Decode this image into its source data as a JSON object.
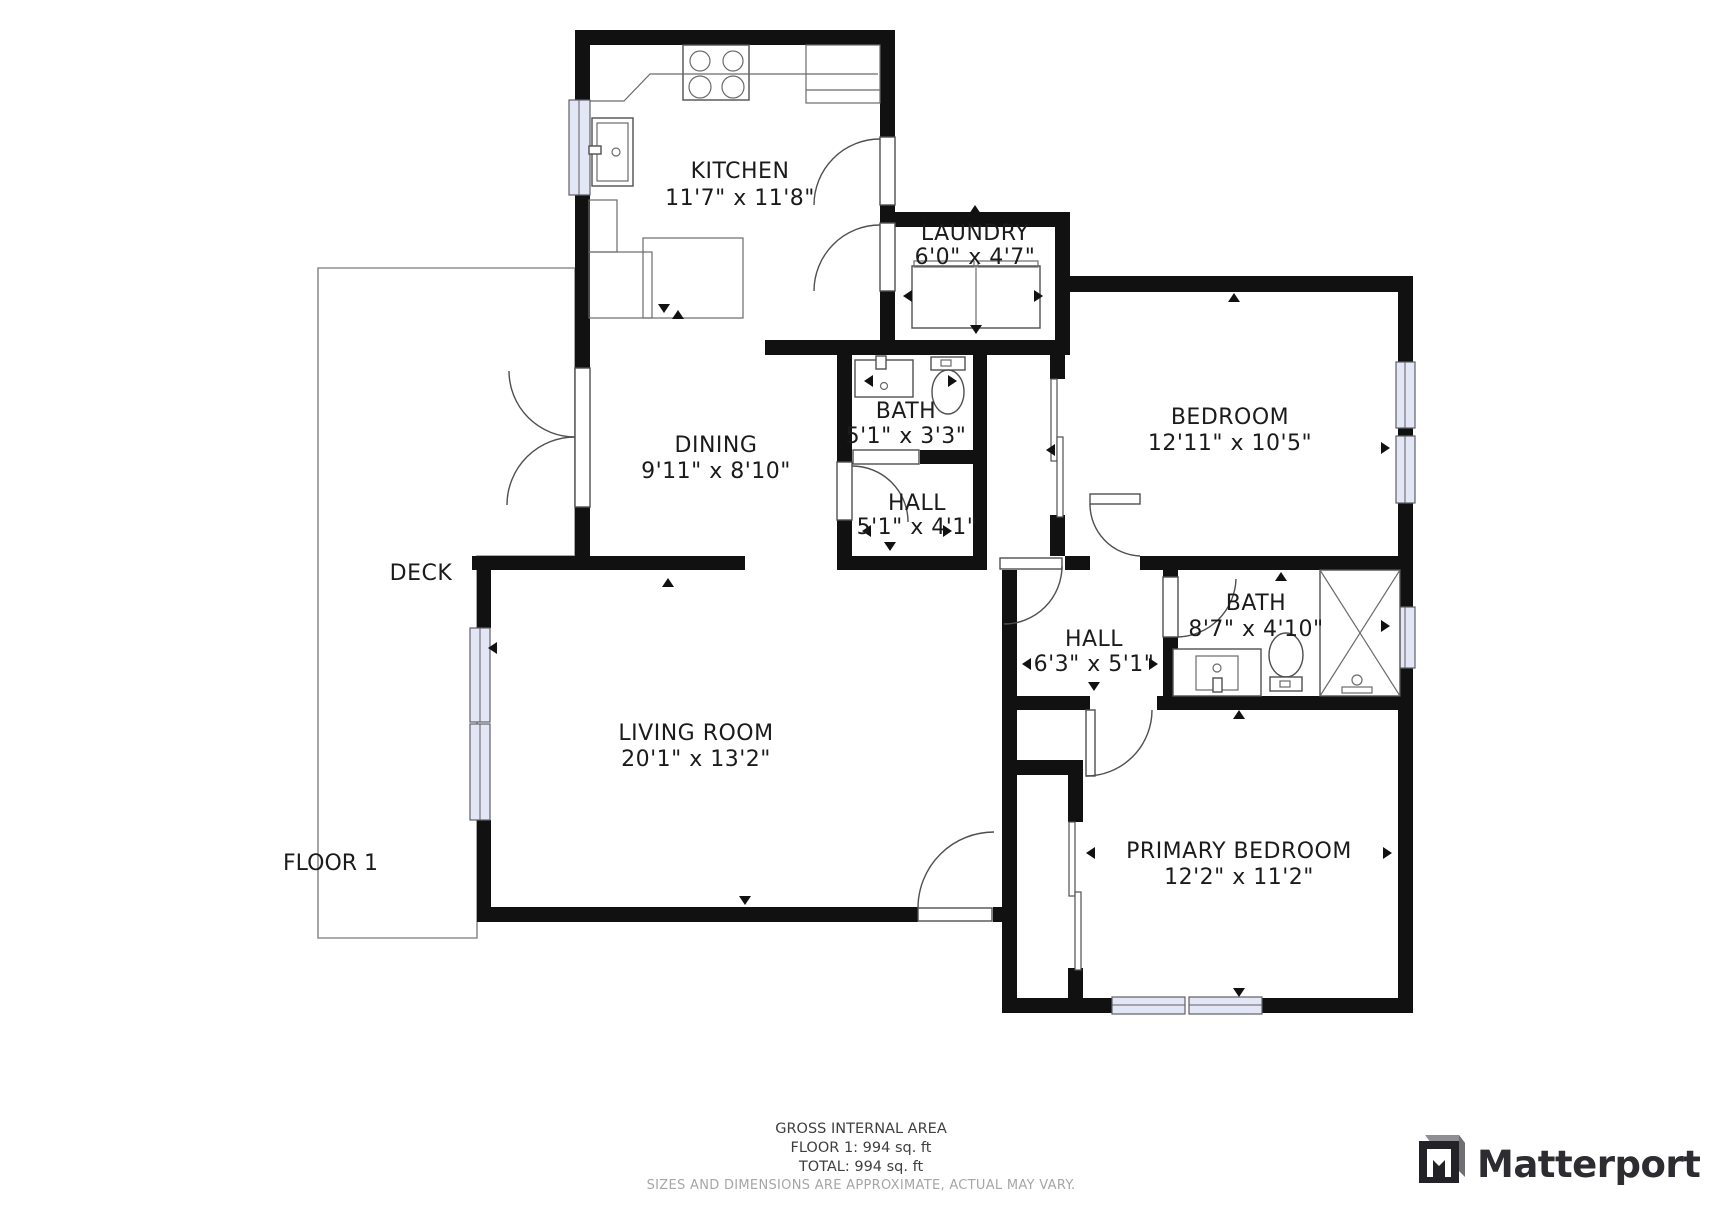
{
  "floorplan": {
    "floor_label": "FLOOR 1",
    "deck_label": "DECK",
    "rooms": {
      "kitchen": {
        "name": "KITCHEN",
        "dims": "11'7\" x 11'8\""
      },
      "dining": {
        "name": "DINING",
        "dims": "9'11\" x 8'10\""
      },
      "laundry": {
        "name": "LAUNDRY",
        "dims": "6'0\" x 4'7\""
      },
      "bath1": {
        "name": "BATH",
        "dims": "5'1\" x 3'3\""
      },
      "hall1": {
        "name": "HALL",
        "dims": "5'1\" x 4'1\""
      },
      "bedroom": {
        "name": "BEDROOM",
        "dims": "12'11\" x 10'5\""
      },
      "hall2": {
        "name": "HALL",
        "dims": "6'3\" x 5'1\""
      },
      "bath2": {
        "name": "BATH",
        "dims": "8'7\" x 4'10\""
      },
      "living": {
        "name": "LIVING ROOM",
        "dims": "20'1\" x 13'2\""
      },
      "primary": {
        "name": "PRIMARY BEDROOM",
        "dims": "12'2\" x 11'2\""
      }
    },
    "fixtures": [
      "stove-burners",
      "kitchen-sink",
      "refrigerator",
      "kitchen-counter",
      "washer",
      "dryer",
      "bathroom-sink",
      "toilet",
      "vanity-sink",
      "shower",
      "closet-slider",
      "pocket-door"
    ]
  },
  "footer": {
    "gross_title": "GROSS INTERNAL AREA",
    "floor_area": "FLOOR 1: 994 sq. ft",
    "total_area": "TOTAL: 994 sq. ft",
    "disclaimer": "SIZES AND DIMENSIONS ARE APPROXIMATE, ACTUAL MAY VARY."
  },
  "branding": {
    "logo_text": "Matterport"
  },
  "colors": {
    "wall": "#111111",
    "window_fill": "#e3e6f4",
    "fixture_stroke": "#4f4f4f",
    "label_text": "#1b1b1b",
    "footer_text": "#3f3f3f",
    "footer_muted": "#a6a6a6",
    "logo": "#2c2c31"
  }
}
